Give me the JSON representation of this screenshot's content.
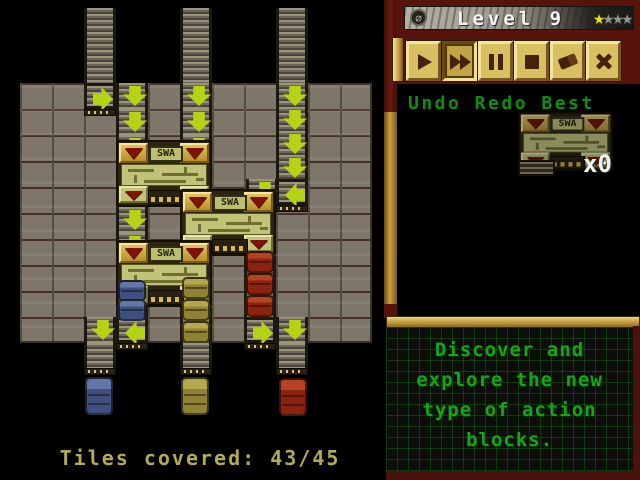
{
  "level_bar": {
    "title": "Level 9",
    "stars_earned": 1,
    "stars_total": 4,
    "menu_icon_glyph": "∅"
  },
  "toolbar": {
    "buttons": [
      {
        "id": "play",
        "icon": "play-icon",
        "pressed": false
      },
      {
        "id": "fast-forward",
        "icon": "fast-forward-icon",
        "pressed": true
      },
      {
        "id": "pause",
        "icon": "pause-icon",
        "pressed": false
      },
      {
        "id": "stop",
        "icon": "stop-icon",
        "pressed": false
      },
      {
        "id": "eraser",
        "icon": "eraser-icon",
        "pressed": false
      },
      {
        "id": "close",
        "icon": "x-icon",
        "pressed": false
      }
    ]
  },
  "history": {
    "label": "Undo Redo Best"
  },
  "inventory": {
    "machine_label": "SWA",
    "count_label": "x0"
  },
  "message": {
    "lines": [
      "Discover and",
      "explore the new",
      "type of action",
      "blocks."
    ]
  },
  "status": {
    "tiles_covered_label": "Tiles covered: 43/45"
  },
  "colors": {
    "accent_gold": "#c9a243",
    "panel_maroon": "#56140c",
    "arrow_green": "#b5d314",
    "text_green": "#17a417",
    "star_yellow": "#ece01e",
    "status_olive": "#b2aa54"
  },
  "board": {
    "machine_label": "SWA",
    "grid": {
      "x": 20,
      "y": 83,
      "cols": 11,
      "rows": 10,
      "tile_w": 32,
      "tile_h": 26
    },
    "strips": [
      {
        "x": 84,
        "y": 8,
        "h": 75
      },
      {
        "x": 180,
        "y": 8,
        "h": 75
      },
      {
        "x": 276,
        "y": 8,
        "h": 75
      },
      {
        "x": 116,
        "y": 307,
        "h": 36
      },
      {
        "x": 180,
        "y": 307,
        "h": 36
      },
      {
        "x": 244,
        "y": 256,
        "h": 61
      },
      {
        "x": 84,
        "y": 343,
        "h": 31
      },
      {
        "x": 180,
        "y": 343,
        "h": 31
      },
      {
        "x": 276,
        "y": 343,
        "h": 31
      }
    ],
    "arrows": [
      {
        "x": 84,
        "y": 83,
        "dir": "right"
      },
      {
        "x": 116,
        "y": 83,
        "dir": "down"
      },
      {
        "x": 116,
        "y": 109,
        "dir": "down"
      },
      {
        "x": 116,
        "y": 135,
        "dir": "down"
      },
      {
        "x": 180,
        "y": 83,
        "dir": "down"
      },
      {
        "x": 180,
        "y": 109,
        "dir": "down"
      },
      {
        "x": 180,
        "y": 135,
        "dir": "down"
      },
      {
        "x": 276,
        "y": 83,
        "dir": "down"
      },
      {
        "x": 276,
        "y": 107,
        "dir": "down"
      },
      {
        "x": 276,
        "y": 131,
        "dir": "down"
      },
      {
        "x": 276,
        "y": 155,
        "dir": "down"
      },
      {
        "x": 276,
        "y": 179,
        "dir": "left"
      },
      {
        "x": 246,
        "y": 179,
        "dir": "down"
      },
      {
        "x": 116,
        "y": 207,
        "dir": "down"
      },
      {
        "x": 116,
        "y": 233,
        "dir": "down"
      },
      {
        "x": 84,
        "y": 317,
        "dir": "down"
      },
      {
        "x": 116,
        "y": 317,
        "dir": "left"
      },
      {
        "x": 244,
        "y": 317,
        "dir": "right"
      },
      {
        "x": 276,
        "y": 317,
        "dir": "down"
      }
    ],
    "caps": [
      {
        "x": 84,
        "y": 109
      },
      {
        "x": 276,
        "y": 205
      },
      {
        "x": 116,
        "y": 343
      },
      {
        "x": 244,
        "y": 343
      },
      {
        "x": 84,
        "y": 368
      },
      {
        "x": 180,
        "y": 368
      },
      {
        "x": 276,
        "y": 368
      }
    ],
    "machines": [
      {
        "x": 116,
        "y": 140
      },
      {
        "x": 180,
        "y": 189
      },
      {
        "x": 116,
        "y": 240
      }
    ],
    "barrels": [
      {
        "x": 118,
        "y": 280,
        "color": "blue"
      },
      {
        "x": 118,
        "y": 299,
        "color": "blue"
      },
      {
        "x": 182,
        "y": 277,
        "color": "olive"
      },
      {
        "x": 182,
        "y": 299,
        "color": "olive"
      },
      {
        "x": 182,
        "y": 321,
        "color": "olive"
      },
      {
        "x": 246,
        "y": 251,
        "color": "red"
      },
      {
        "x": 246,
        "y": 273,
        "color": "red"
      },
      {
        "x": 246,
        "y": 295,
        "color": "red"
      }
    ],
    "targets": [
      {
        "x": 85,
        "y": 377,
        "color": "blue"
      },
      {
        "x": 181,
        "y": 377,
        "color": "olive"
      },
      {
        "x": 279,
        "y": 378,
        "color": "red"
      }
    ]
  }
}
